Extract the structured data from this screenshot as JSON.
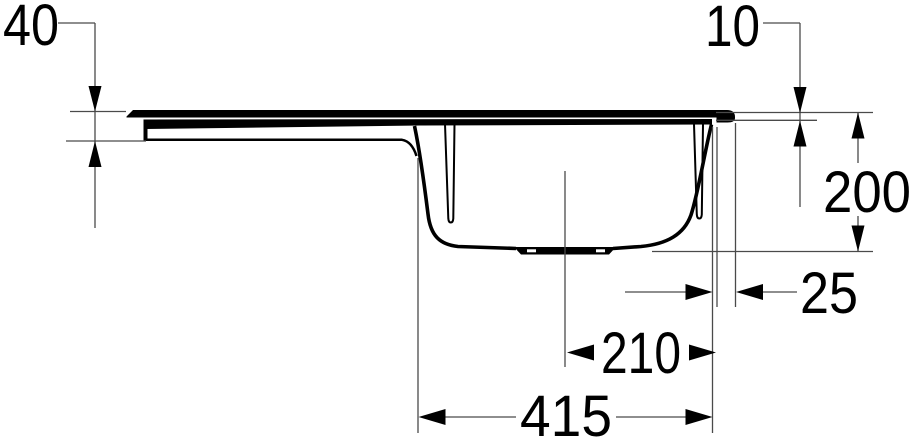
{
  "drawing": {
    "subject": "kitchen-sink-side-section-technical-drawing",
    "unit": "mm",
    "background_color": "#ffffff",
    "profile_line_color": "#000000",
    "dimension_line_color": "#4a4a4a",
    "dimensions": {
      "left_edge_height": "40",
      "right_rim_thickness": "10",
      "bowl_depth": "200",
      "bowl_edge_to_sink_edge": "25",
      "drain_center_to_bowl_edge": "210",
      "bowl_length": "415"
    }
  }
}
